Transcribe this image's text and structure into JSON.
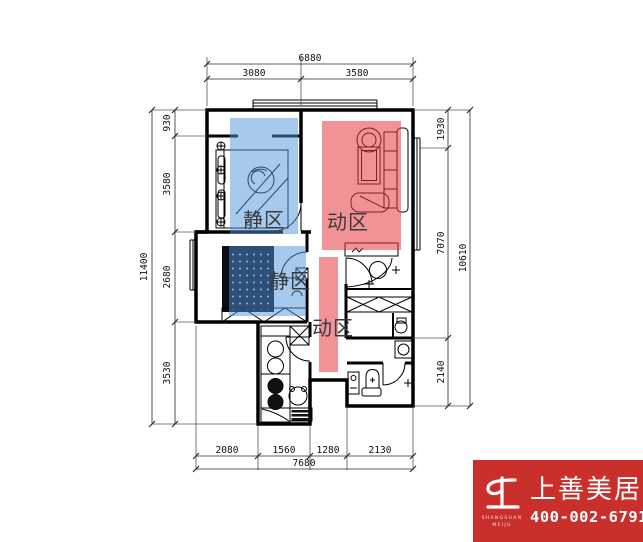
{
  "plan": {
    "zone_labels": {
      "bedroom1": "静区",
      "bedroom2": "静区",
      "living": "动区",
      "corridor": "动区"
    },
    "dimensions": {
      "top": {
        "total": "6880",
        "segments": [
          "3080",
          "3580"
        ]
      },
      "bottom": {
        "total": "7680",
        "segments": [
          "2080",
          "1560",
          "1280",
          "2130"
        ]
      },
      "left": {
        "total": "11400",
        "segments": [
          "930",
          "3580",
          "2680",
          "3530"
        ]
      },
      "right": {
        "total": "10610",
        "segments": [
          "1930",
          "7070",
          "2140"
        ]
      }
    },
    "colors": {
      "quiet_zone": "#4D94DB",
      "active_zone": "#E63A40"
    }
  },
  "logo": {
    "brand": "上善美居",
    "phone": "400-002-6791",
    "latin_line1": "SHANGSHAN",
    "latin_line2": "MEIJU",
    "bg_color": "#C9302B"
  }
}
